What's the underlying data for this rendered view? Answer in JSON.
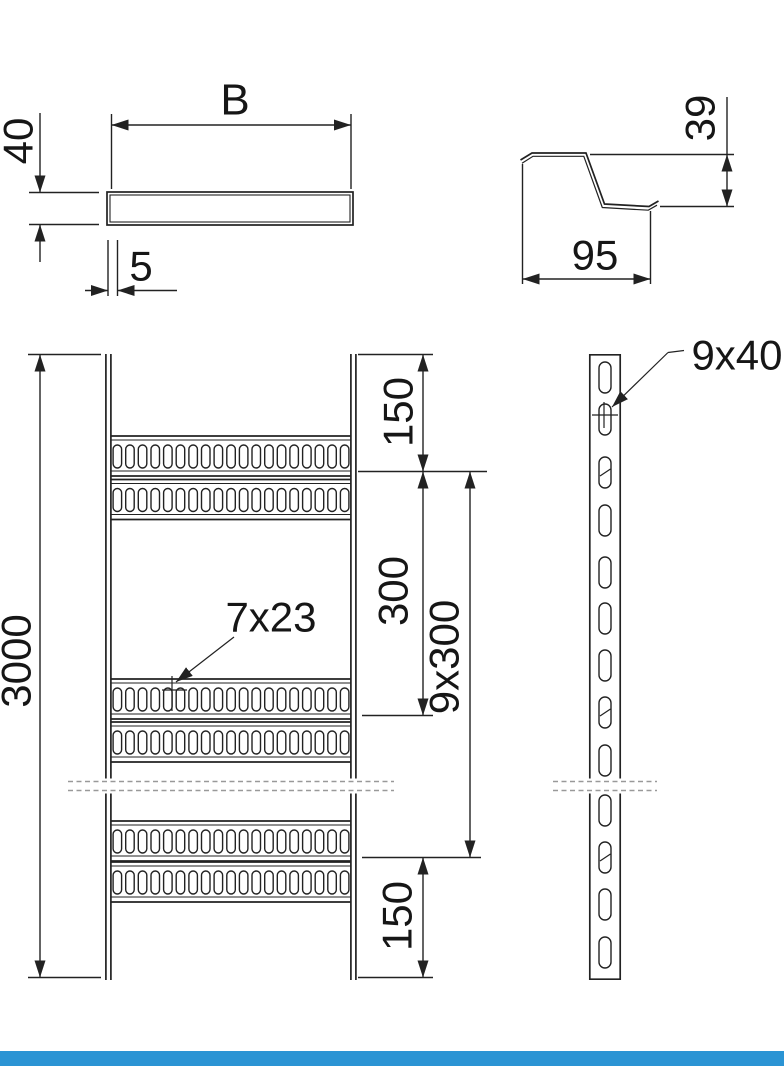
{
  "colors": {
    "line": "#222222",
    "text": "#161616",
    "break_line": "#999999",
    "footer_bar": "#2b94d4",
    "background": "#ffffff"
  },
  "views": {
    "cover_section": {
      "width_label": "B",
      "height_label": "40",
      "thickness_label": "5"
    },
    "rung_profile": {
      "height_label": "39",
      "width_label": "95"
    },
    "front_view": {
      "length_label": "3000",
      "top_end_spacing_label": "150",
      "rung_spacing_label": "300",
      "total_rung_spacing_label": "9x300",
      "bottom_end_spacing_label": "150",
      "rung_slot_label": "7x23"
    },
    "side_view": {
      "rail_slot_label": "9x40"
    }
  }
}
